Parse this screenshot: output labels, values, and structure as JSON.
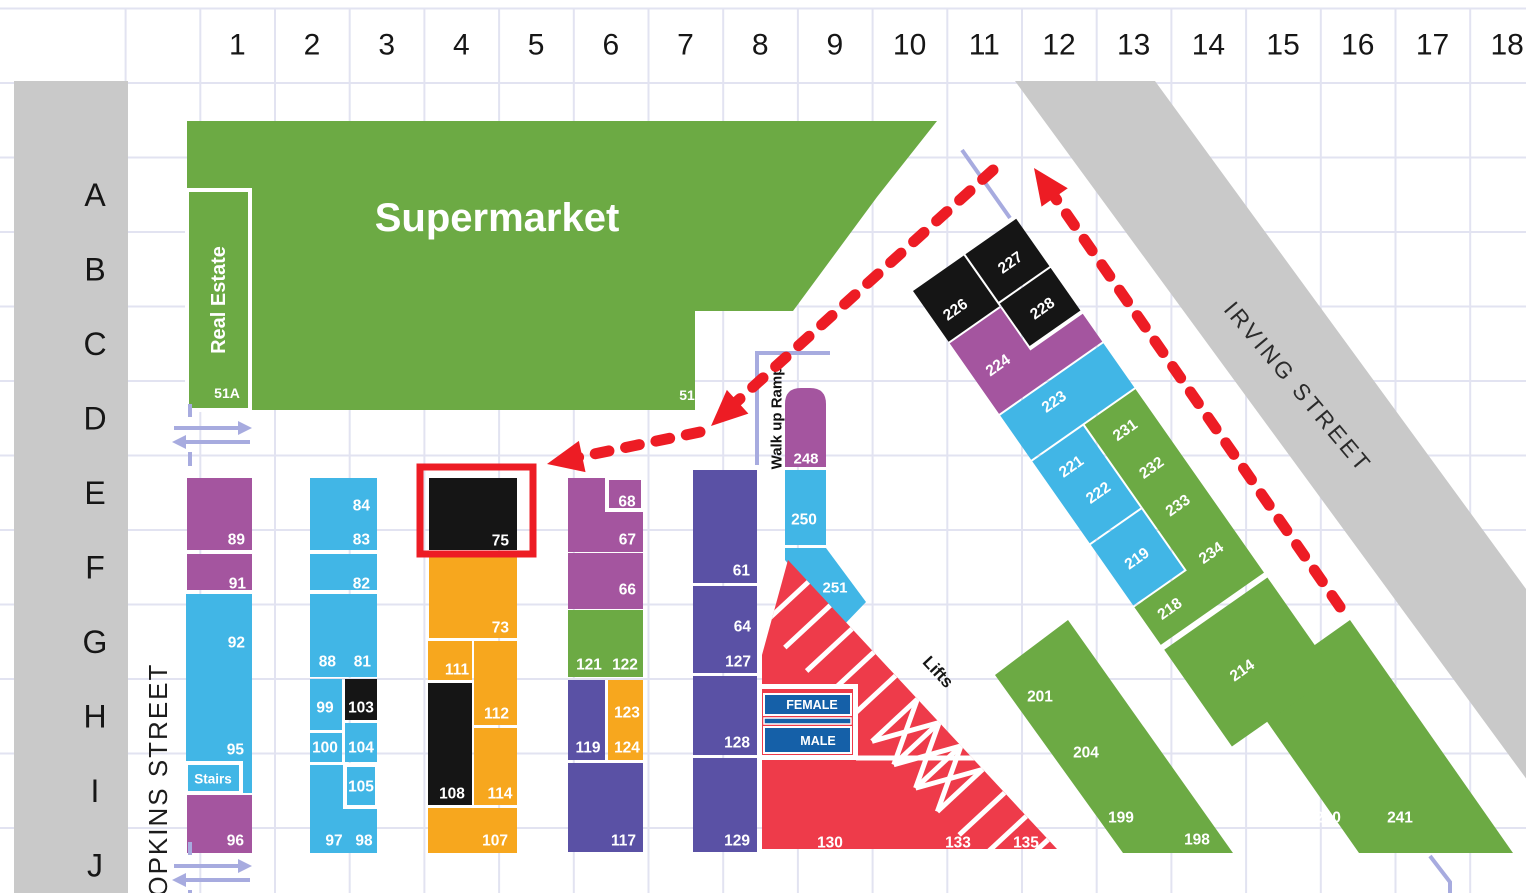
{
  "colors": {
    "green": "#6caa44",
    "blue": "#41b6e6",
    "purple": "#a4559f",
    "indigo": "#5a51a5",
    "orange": "#f7a71e",
    "black": "#151515",
    "red": "#ee3b4a",
    "toilet_blue": "#1560a8",
    "street_gray": "#c9c9c9",
    "grid_line": "#e2e3f1",
    "lavender": "#a7abdf",
    "annotation_red": "#ed1c24",
    "label_dark": "#161616",
    "label_white": "#ffffff"
  },
  "grid": {
    "columns": [
      "1",
      "2",
      "3",
      "4",
      "5",
      "6",
      "7",
      "8",
      "9",
      "10",
      "11",
      "12",
      "13",
      "14",
      "15",
      "16",
      "17",
      "18"
    ],
    "rows": [
      "A",
      "B",
      "C",
      "D",
      "E",
      "F",
      "G",
      "H",
      "I",
      "J"
    ]
  },
  "streets": {
    "hopkins": "HOPKINS STREET",
    "irving": "IRVING STREET"
  },
  "landmarks": {
    "supermarket": "Supermarket",
    "real_estate": "Real Estate",
    "unit_51a": "51A",
    "unit_51": "51",
    "ramp": "Walk up Ramp",
    "lifts": "Lifts",
    "female": "FEMALE",
    "male": "MALE"
  },
  "stalls": [
    {
      "n": "89",
      "c": "purple",
      "r": [
        187,
        478,
        65,
        72
      ],
      "l": [
        245,
        540
      ],
      "a": "end"
    },
    {
      "n": "91",
      "c": "purple",
      "r": [
        187,
        554,
        65,
        36
      ],
      "l": [
        246,
        584
      ],
      "a": "end"
    },
    {
      "n": "92",
      "c": "blue",
      "r": [
        186,
        594,
        66,
        169
      ],
      "l": [
        245,
        643
      ],
      "a": "end"
    },
    {
      "n": "95",
      "l": [
        244,
        750
      ],
      "a": "end"
    },
    {
      "c": "blue",
      "r": [
        240,
        763,
        12,
        30
      ]
    },
    {
      "n": "Stairs",
      "c": "blue",
      "r": [
        186,
        763,
        55,
        30
      ],
      "w": 1,
      "l": [
        213,
        779
      ],
      "ls": 13.5
    },
    {
      "n": "96",
      "c": "purple",
      "r": [
        187,
        795,
        65,
        58
      ],
      "l": [
        244,
        841
      ],
      "a": "end"
    },
    {
      "n": "84",
      "c": "blue",
      "r": [
        310,
        478,
        67,
        72
      ],
      "l": [
        370,
        506
      ],
      "a": "end"
    },
    {
      "n": "83",
      "l": [
        370,
        540
      ],
      "a": "end"
    },
    {
      "n": "82",
      "c": "blue",
      "r": [
        310,
        554,
        67,
        36
      ],
      "l": [
        370,
        584
      ],
      "a": "end"
    },
    {
      "n": "88",
      "c": "blue",
      "r": [
        310,
        594,
        67,
        83
      ],
      "l": [
        336,
        662
      ],
      "a": "end"
    },
    {
      "n": "81",
      "l": [
        371,
        662
      ],
      "a": "end"
    },
    {
      "n": "99",
      "c": "blue",
      "r": [
        310,
        679,
        32,
        51
      ],
      "l": [
        325,
        708
      ]
    },
    {
      "n": "103",
      "c": "black",
      "r": [
        345,
        679,
        32,
        41
      ],
      "l": [
        361,
        708
      ]
    },
    {
      "n": "100",
      "c": "blue",
      "r": [
        310,
        733,
        32,
        29
      ],
      "l": [
        325,
        748
      ]
    },
    {
      "n": "104",
      "c": "blue",
      "r": [
        345,
        723,
        32,
        39
      ],
      "l": [
        361,
        748
      ]
    },
    {
      "n": "97",
      "c": "blue",
      "r": [
        310,
        765,
        67,
        88
      ],
      "l": [
        334,
        841
      ]
    },
    {
      "n": "98",
      "l": [
        364,
        841
      ]
    },
    {
      "n": "105",
      "c": "blue",
      "r": [
        345,
        765,
        32,
        42
      ],
      "w": 1,
      "l": [
        361,
        787
      ]
    },
    {
      "n": "75",
      "c": "black",
      "r": [
        429,
        478,
        88,
        72
      ],
      "l": [
        509,
        541
      ],
      "a": "end"
    },
    {
      "n": "73",
      "c": "orange",
      "r": [
        429,
        555,
        88,
        83
      ],
      "l": [
        509,
        628
      ],
      "a": "end"
    },
    {
      "n": "111",
      "c": "orange",
      "r": [
        428,
        641,
        44,
        39
      ],
      "l": [
        457,
        670
      ]
    },
    {
      "n": "112",
      "c": "orange",
      "r": [
        474,
        641,
        43,
        84
      ],
      "l": [
        509,
        714
      ],
      "a": "end"
    },
    {
      "n": "108",
      "c": "black",
      "r": [
        428,
        683,
        44,
        122
      ],
      "l": [
        452,
        794
      ]
    },
    {
      "n": "114",
      "c": "orange",
      "r": [
        474,
        728,
        43,
        77
      ],
      "l": [
        500,
        794
      ]
    },
    {
      "n": "107",
      "c": "orange",
      "r": [
        428,
        808,
        89,
        45
      ],
      "l": [
        508,
        841
      ],
      "a": "end"
    },
    {
      "n": "67",
      "c": "purple",
      "r": [
        568,
        478,
        75,
        74
      ],
      "l": [
        636,
        540
      ],
      "a": "end"
    },
    {
      "n": "68",
      "c": "purple",
      "r": [
        607,
        478,
        36,
        32
      ],
      "w": 1,
      "l": [
        627,
        502
      ]
    },
    {
      "n": "66",
      "c": "purple",
      "r": [
        568,
        553,
        75,
        56
      ],
      "l": [
        636,
        590
      ],
      "a": "end"
    },
    {
      "n": "121",
      "c": "green",
      "r": [
        568,
        610,
        75,
        67
      ],
      "l": [
        589,
        665
      ]
    },
    {
      "n": "122",
      "l": [
        625,
        665
      ]
    },
    {
      "n": "119",
      "c": "indigo",
      "r": [
        568,
        680,
        37,
        80
      ],
      "l": [
        588,
        748
      ]
    },
    {
      "n": "123",
      "c": "orange",
      "r": [
        608,
        680,
        35,
        80
      ],
      "l": [
        627,
        713
      ]
    },
    {
      "n": "124",
      "l": [
        627,
        748
      ]
    },
    {
      "n": "117",
      "c": "indigo",
      "r": [
        568,
        763,
        75,
        89
      ],
      "l": [
        636,
        841
      ],
      "a": "end"
    },
    {
      "n": "61",
      "c": "indigo",
      "r": [
        693,
        470,
        64,
        113
      ],
      "l": [
        750,
        571
      ],
      "a": "end"
    },
    {
      "n": "64",
      "c": "indigo",
      "r": [
        693,
        586,
        64,
        87
      ],
      "l": [
        751,
        627
      ],
      "a": "end"
    },
    {
      "n": "127",
      "l": [
        751,
        662
      ],
      "a": "end"
    },
    {
      "n": "128",
      "c": "indigo",
      "r": [
        693,
        676,
        64,
        79
      ],
      "l": [
        750,
        743
      ],
      "a": "end"
    },
    {
      "n": "129",
      "c": "indigo",
      "r": [
        693,
        758,
        64,
        94
      ],
      "l": [
        750,
        841
      ],
      "a": "end"
    },
    {
      "n": "248",
      "c": "purple",
      "path": "M785,404 Q785,388 801,388 L810,388 Q826,388 826,404 L826,467 L785,467 Z",
      "l": [
        806,
        459
      ],
      "ls": 15
    },
    {
      "n": "250",
      "c": "blue",
      "r": [
        785,
        470,
        41,
        75
      ],
      "l": [
        804,
        520
      ]
    },
    {
      "n": "251",
      "c": "blue",
      "p": "785,548 826,548 866,602 841,628 785,560",
      "l": [
        835,
        588
      ],
      "ls": 15
    },
    {
      "c": "red",
      "p": "788,560 1057,849 762,849 762,655"
    },
    {
      "n": "130",
      "l": [
        830,
        843
      ]
    },
    {
      "n": "133",
      "l": [
        958,
        843
      ]
    },
    {
      "n": "135",
      "l": [
        1026,
        843
      ]
    },
    {
      "n": "201",
      "c": "green",
      "p": "995,675 1068,620 1233,853 1123,853",
      "l": [
        1040,
        697
      ]
    },
    {
      "n": "204",
      "l": [
        1086,
        753
      ]
    },
    {
      "n": "199",
      "l": [
        1121,
        818
      ]
    },
    {
      "n": "198",
      "l": [
        1197,
        840
      ]
    },
    {
      "n": "210",
      "c": "green",
      "p": "1247,693 1350,620 1513,853 1359,853",
      "l": [
        1328,
        818
      ]
    },
    {
      "n": "241",
      "l": [
        1400,
        818
      ]
    }
  ],
  "diagonal_stalls": {
    "pivot": [
      913,
      291
    ],
    "angle": -35,
    "items": [
      {
        "n": "226",
        "c": "black",
        "r": [
          0,
          0,
          62,
          62
        ],
        "l": [
          24,
          40
        ]
      },
      {
        "n": "227",
        "c": "black",
        "r": [
          64,
          0,
          62,
          58
        ],
        "l": [
          96,
          33
        ]
      },
      {
        "n": "228",
        "c": "black",
        "r": [
          64,
          60,
          62,
          52
        ],
        "l": [
          96,
          89
        ]
      },
      {
        "n": "224",
        "c": "purple",
        "p": "0,64 62,64 62,116 126,116 126,150 0,150",
        "l": [
          27,
          110
        ]
      },
      {
        "n": "223",
        "c": "blue",
        "r": [
          0,
          152,
          126,
          54
        ],
        "l": [
          52,
          172
        ]
      },
      {
        "n": "221",
        "c": "blue",
        "r": [
          0,
          208,
          62,
          100
        ],
        "l": [
          29,
          235
        ]
      },
      {
        "n": "222",
        "l": [
          36,
          272
        ]
      },
      {
        "n": "219",
        "c": "blue",
        "r": [
          0,
          310,
          62,
          74
        ],
        "l": [
          30,
          348
        ]
      },
      {
        "n": "231",
        "c": "green",
        "p": "64,208 126,208 126,432 0,432 0,386 64,386",
        "l": [
          94,
          236
        ]
      },
      {
        "n": "232",
        "l": [
          94,
          282
        ]
      },
      {
        "n": "233",
        "l": [
          94,
          328
        ]
      },
      {
        "n": "234",
        "l": [
          94,
          386
        ]
      },
      {
        "n": "218",
        "l": [
          28,
          408
        ]
      },
      {
        "n": "214",
        "c": "green",
        "r": [
          0,
          438,
          126,
          118
        ],
        "l": [
          52,
          500
        ]
      }
    ]
  },
  "toilets": {
    "female_label_pos": [
      812,
      705
    ],
    "male_label_pos": [
      818,
      741
    ]
  },
  "annotations": {
    "highlight_box": [
      420,
      467,
      113,
      87
    ],
    "route_in_1": {
      "line": [
        993,
        170,
        733,
        405
      ],
      "head": [
        711,
        426
      ],
      "head_angle": 137.7
    },
    "route_in_2": {
      "line": [
        700,
        432,
        575,
        458
      ],
      "head": [
        547,
        464
      ],
      "head_angle": 168
    },
    "route_out": {
      "line": [
        1340,
        607,
        1054,
        196
      ],
      "head": [
        1034,
        168
      ],
      "head_angle": -125
    }
  }
}
